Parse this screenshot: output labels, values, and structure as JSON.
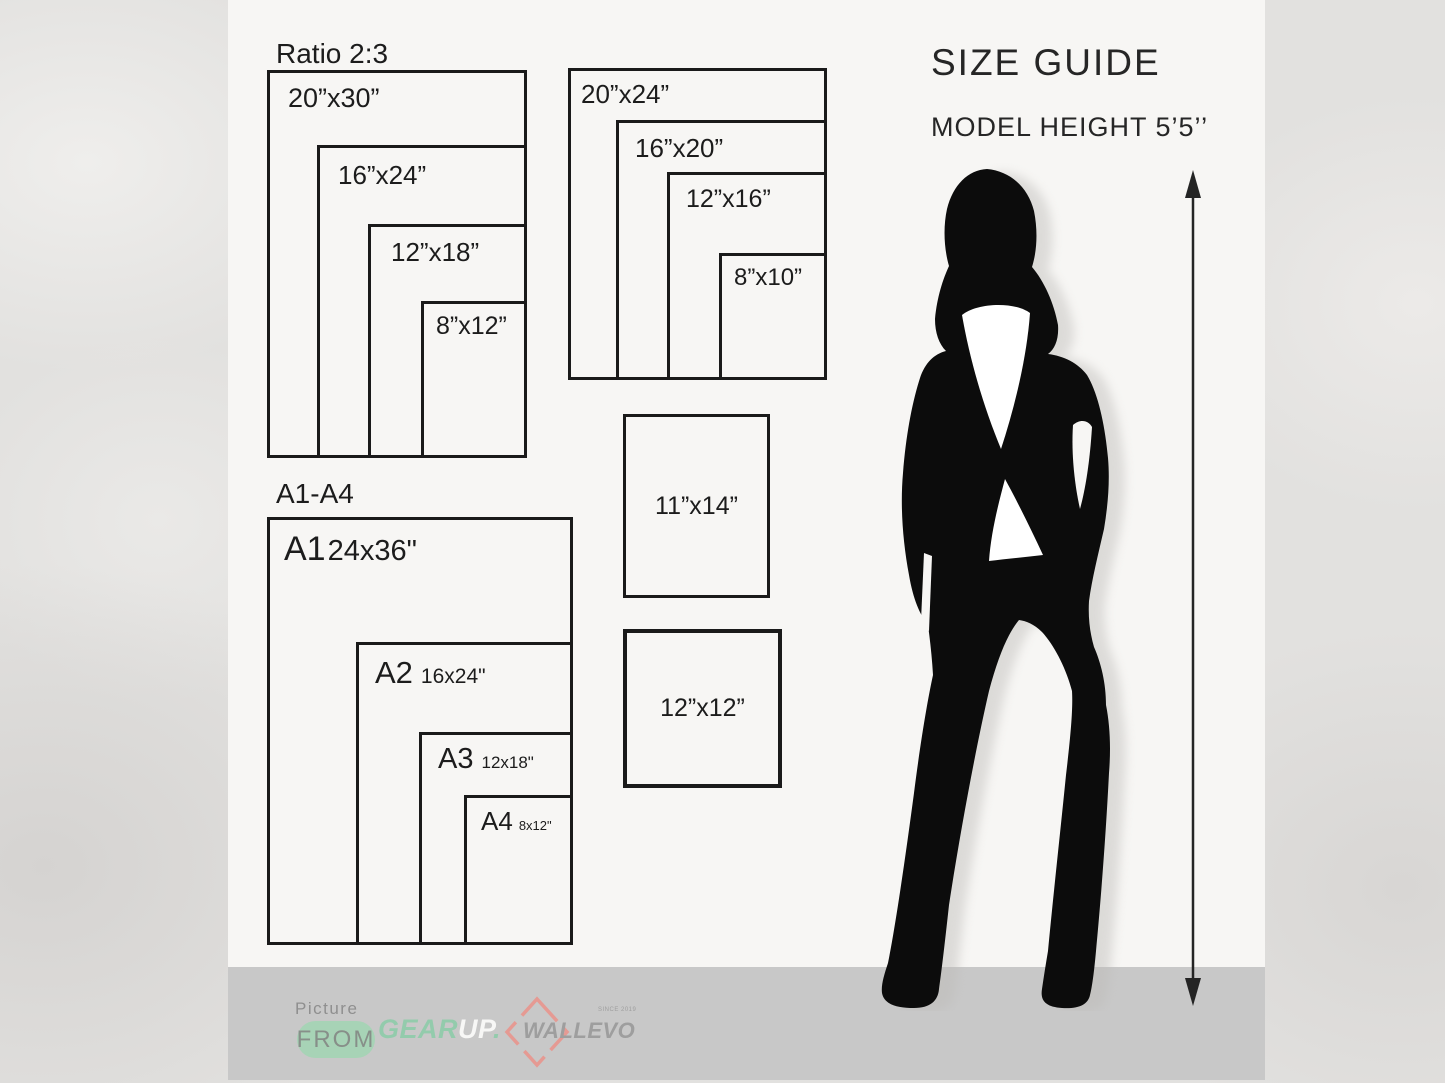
{
  "header": {
    "title": "SIZE GUIDE",
    "model_height": "MODEL HEIGHT 5’5’’"
  },
  "size_groups": {
    "ratio23": {
      "title": "Ratio 2:3",
      "sizes": [
        "20”x30”",
        "16”x24”",
        "12”x18”",
        "8”x12”"
      ]
    },
    "group2024": {
      "sizes": [
        "20”x24”",
        "16”x20”",
        "12”x16”",
        "8”x10”"
      ]
    },
    "a_series": {
      "title": "A1-A4",
      "sizes": [
        {
          "name": "A1",
          "dim": "24x36\""
        },
        {
          "name": "A2",
          "dim": "16x24\""
        },
        {
          "name": "A3",
          "dim": "12x18\""
        },
        {
          "name": "A4",
          "dim": "8x12\""
        }
      ]
    },
    "singles": [
      "11”x14”",
      "12”x12”"
    ]
  },
  "footer": {
    "picture_label": "Picture",
    "from_label": "FROM",
    "gearup": {
      "part1": "GEAR",
      "part2": "UP",
      "dot": "."
    },
    "wallevo": {
      "name": "WALLEVO",
      "since": "SINCE 2019"
    }
  },
  "colors": {
    "ink": "#1c1c1c",
    "card_bg": "#f7f6f4",
    "footer_band": "#c8c8c8",
    "mint_accent": "#a7d3b6",
    "gear_green": "#93cbac",
    "wallevo_gray": "#9e9e9e",
    "wallevo_pink": "#e59a93"
  }
}
